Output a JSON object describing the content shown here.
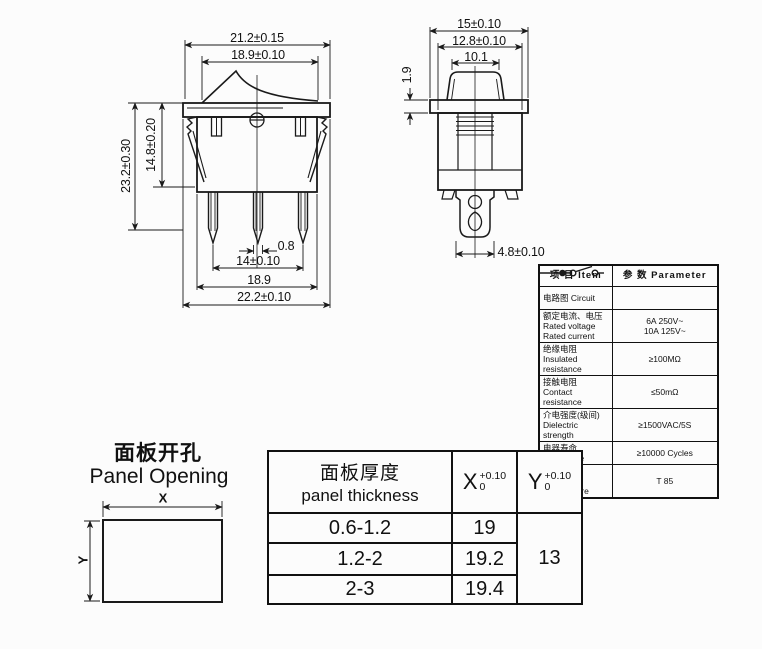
{
  "drawing": {
    "front_view": {
      "dim_top_outer": "21.2±0.15",
      "dim_top_inner": "18.9±0.10",
      "dim_left_total": "23.2±0.30",
      "dim_left_body": "14.8±0.20",
      "dim_terminal_thickness": "0.8",
      "dim_terminal_span": "14±0.10",
      "dim_bottom_inner": "18.9",
      "dim_bottom_outer": "22.2±0.10"
    },
    "side_view": {
      "dim_top_outer": "15±0.10",
      "dim_top_inner": "12.8±0.10",
      "dim_rocker": "10.1",
      "dim_flange": "1.9",
      "dim_terminal": "4.8±0.10"
    }
  },
  "spec_table": {
    "header": {
      "item": "项 目  Item",
      "parameter": "参 数  Parameter"
    },
    "rows": [
      {
        "item": "电路图  Circuit",
        "value": ""
      },
      {
        "item": "额定电流、电压\nRated voltage\nRated current",
        "value": "6A 250V~\n10A 125V~"
      },
      {
        "item": "绝缘电阻\nInsulated\nresistance",
        "value": "≥100MΩ"
      },
      {
        "item": "接触电阻\nContact resistance",
        "value": "≤50mΩ"
      },
      {
        "item": "介电强度(级间)\nDielectric strength",
        "value": "≥1500VAC/5S"
      },
      {
        "item": "电器寿命  Endurance",
        "value": "≥10000 Cycles"
      },
      {
        "item": "使用温度\nAmbient temperature",
        "value": "T 85"
      }
    ]
  },
  "panel_opening": {
    "title_cn": "面板开孔",
    "title_en": "Panel Opening",
    "x_label": "X",
    "y_label": "Y"
  },
  "panel_table": {
    "col1_cn": "面板厚度",
    "col1_en": "panel thickness",
    "x_label": "X",
    "y_label": "Y",
    "tolerance_sup": "+0.10",
    "tolerance_sub": "0",
    "rows": [
      {
        "thickness": "0.6-1.2",
        "x": "19"
      },
      {
        "thickness": "1.2-2",
        "x": "19.2"
      },
      {
        "thickness": "2-3",
        "x": "19.4"
      }
    ],
    "y_value": "13"
  },
  "colors": {
    "line": "#1a1a1a",
    "background": "#fcfcfc"
  }
}
